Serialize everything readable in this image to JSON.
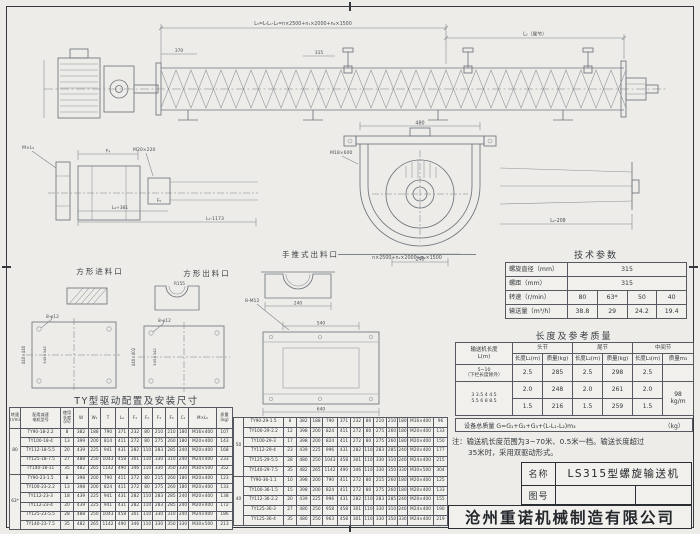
{
  "view_labels": {
    "square_inlet": "方形进料口",
    "square_outlet": "方形出料口",
    "push_outlet": "手推式出料口"
  },
  "ann": {
    "total": "L₃=L-L₁-L₂=n×2500+n₁×2000+n₂×1500",
    "tail": "L₂（尾节）",
    "p370": "370",
    "p315": "315",
    "mxl5": "M×L₅",
    "f4": "F₄",
    "f5": "F₅",
    "m20": "M20×220",
    "l4381": "L₄+381",
    "l11173": "L₁-1173",
    "l2208": "L₂-208",
    "w480": "480",
    "w240": "240",
    "m18": "M18×600",
    "n2500": "n×2500+n₁×2000+n₂×1500",
    "b8f12": "8-φ12",
    "b8m12": "8-M12",
    "r155": "R155",
    "sqA_o": "440×440",
    "sqA_i": "345×345",
    "sqB_o": "440×402",
    "sqB_i": "345×342",
    "d540": "540",
    "d640": "640"
  },
  "tech_params": {
    "title": "技术参数",
    "rows": [
      [
        "螺旋直径（mm）",
        {
          "t": "315",
          "cs": 4
        }
      ],
      [
        "螺距（mm）",
        {
          "t": "315",
          "cs": 4
        }
      ],
      [
        "转速（r/min）",
        "80",
        "63*",
        "50",
        "40"
      ],
      [
        "输送量（m³/h）",
        "38.8",
        "29",
        "24.2",
        "19.4"
      ]
    ]
  },
  "length_mass": {
    "title": "长度及参考质量",
    "header_rows": [
      [
        {
          "t": "输送机长度\nL(m)",
          "rs": 2
        },
        {
          "t": "头节",
          "cs": 2
        },
        {
          "t": "尾节",
          "cs": 2
        },
        {
          "t": "中间节",
          "cs": 2
        }
      ],
      [
        "长度L₁(m)",
        "质量(kg)",
        "长度L₂(m)",
        "质量(kg)",
        "长度L₃(m)",
        "质量m₃"
      ]
    ],
    "rows": [
      [
        {
          "t": "5~10\n（下栏长度除外）",
          "cl": "sm"
        },
        "2.5",
        "285",
        "2.5",
        "298",
        "2.5",
        ""
      ],
      [
        {
          "t": "3  3.5  4  4.5\n5.5  6  8  8.5",
          "rs": 2,
          "cl": "sm"
        },
        "2.0",
        "248",
        "2.0",
        "261",
        "2.0",
        {
          "t": "98\nkg/m",
          "rs": 2
        }
      ],
      [
        "1.5",
        "216",
        "1.5",
        "259",
        "1.5"
      ]
    ],
    "formula": "设备总质量  G=G₁+G₂+G₃+(L-L₁-L₂)m₃",
    "formula_unit": "（kg）"
  },
  "note": {
    "line1": "注：输送机长度范围为3~70米、0.5米一档。输送长度超过",
    "line2": "35米时，采用双驱动形式。"
  },
  "drive_table": {
    "title": "TY型驱动配置及安装尺寸",
    "header_rows": [
      [
        {
          "t": "转速\n(r/min)"
        },
        {
          "t": "配用减速\n电机型号"
        },
        {
          "t": "使用\n长度\n(m)"
        },
        "W",
        "W₁",
        "T",
        "L₄",
        "F₁",
        "F₂",
        "F₃",
        "F₄",
        "C₁",
        "M×L₅",
        {
          "t": "质量\n(kg)"
        }
      ]
    ],
    "left_rows": [
      [
        {
          "t": "80",
          "rs": 5
        },
        "TY90-18-2.2",
        "8",
        "382",
        "188",
        "790",
        "371",
        "232",
        "80",
        "210",
        "210",
        "180",
        "M16×400",
        "107"
      ],
      [
        "TY100-18-4",
        "13",
        "399",
        "200",
        "814",
        "411",
        "272",
        "80",
        "275",
        "260",
        "180",
        "M20×400",
        "143"
      ],
      [
        "TY112-18-5.5",
        "20",
        "439",
        "225",
        "941",
        "431",
        "282",
        "110",
        "283",
        "285",
        "240",
        "M20×400",
        "168"
      ],
      [
        "TY125-18-7.5",
        "27",
        "488",
        "250",
        "1043",
        "458",
        "301",
        "110",
        "330",
        "310",
        "240",
        "M24×400",
        "233"
      ],
      [
        "TY140-18-11",
        "35",
        "482",
        "265",
        "1142",
        "490",
        "346",
        "110",
        "330",
        "350",
        "330",
        "M30×500",
        "352"
      ],
      [
        {
          "t": "63*",
          "rs": 6
        },
        "TY90-23-1.5",
        "8",
        "398",
        "200",
        "790",
        "411",
        "272",
        "80",
        "215",
        "260",
        "180",
        "M20×400",
        "123"
      ],
      [
        "TY100-23-2.2",
        "13",
        "398",
        "200",
        "824",
        "411",
        "272",
        "80",
        "275",
        "260",
        "180",
        "M20×400",
        "133"
      ],
      [
        "TY112-23-3",
        "18",
        "439",
        "225",
        "941",
        "431",
        "282",
        "110",
        "283",
        "285",
        "240",
        "M20×400",
        "138"
      ],
      [
        "TY112-23-4",
        "20",
        "439",
        "225",
        "941",
        "431",
        "282",
        "110",
        "283",
        "285",
        "240",
        "M20×400",
        "172"
      ],
      [
        "TY125-23-5.5",
        "28",
        "488",
        "250",
        "1043",
        "458",
        "301",
        "110",
        "330",
        "310",
        "240",
        "M24×400",
        "186"
      ],
      [
        "TY140-23-7.5",
        "35",
        "482",
        "265",
        "1142",
        "490",
        "346",
        "110",
        "330",
        "350",
        "330",
        "M30×500",
        "213"
      ]
    ],
    "right_rows": [
      [
        {
          "t": "50",
          "rs": 6
        },
        "TY90-29-1.5",
        "8",
        "382",
        "188",
        "790",
        "371",
        "232",
        "80",
        "210",
        "210",
        "180",
        "M16×400",
        "96"
      ],
      [
        "TY100-29-2.2",
        "12",
        "398",
        "200",
        "824",
        "411",
        "272",
        "80",
        "275",
        "260",
        "180",
        "M20×400",
        "133"
      ],
      [
        "TY100-29-3",
        "17",
        "398",
        "200",
        "824",
        "411",
        "272",
        "80",
        "275",
        "260",
        "180",
        "M20×400",
        "150"
      ],
      [
        "TY112-29-4",
        "23",
        "439",
        "225",
        "996",
        "431",
        "282",
        "110",
        "283",
        "285",
        "240",
        "M20×400",
        "177"
      ],
      [
        "TY125-29-5.5",
        "28",
        "480",
        "250",
        "1043",
        "458",
        "301",
        "110",
        "330",
        "310",
        "240",
        "M24×400",
        "215"
      ],
      [
        "TY140-29-7.5",
        "35",
        "482",
        "265",
        "1142",
        "490",
        "346",
        "110",
        "330",
        "350",
        "330",
        "M30×500",
        "304"
      ],
      [
        {
          "t": "40",
          "rs": 5
        },
        "TY90-36-1.1",
        "10",
        "398",
        "200",
        "790",
        "411",
        "272",
        "80",
        "215",
        "260",
        "180",
        "M20×400",
        "125"
      ],
      [
        "TY100-36-1.5",
        "15",
        "398",
        "200",
        "824",
        "411",
        "272",
        "80",
        "275",
        "260",
        "180",
        "M20×400",
        "133"
      ],
      [
        "TY112-36-2.2",
        "20",
        "439",
        "225",
        "996",
        "431",
        "282",
        "110",
        "283",
        "285",
        "240",
        "M20×400",
        "155"
      ],
      [
        "TY125-36-3",
        "27",
        "480",
        "250",
        "958",
        "458",
        "301",
        "110",
        "330",
        "310",
        "240",
        "M24×400",
        "190"
      ],
      [
        "TY125-36-4",
        "35",
        "480",
        "250",
        "963",
        "458",
        "301",
        "110",
        "330",
        "350",
        "330",
        "M24×400",
        "219"
      ]
    ]
  },
  "title_block": {
    "name_label": "名称",
    "name_value": "LS315型螺旋输送机",
    "drawing_no_label": "图号",
    "company": "沧州重诺机械制造有限公司"
  }
}
